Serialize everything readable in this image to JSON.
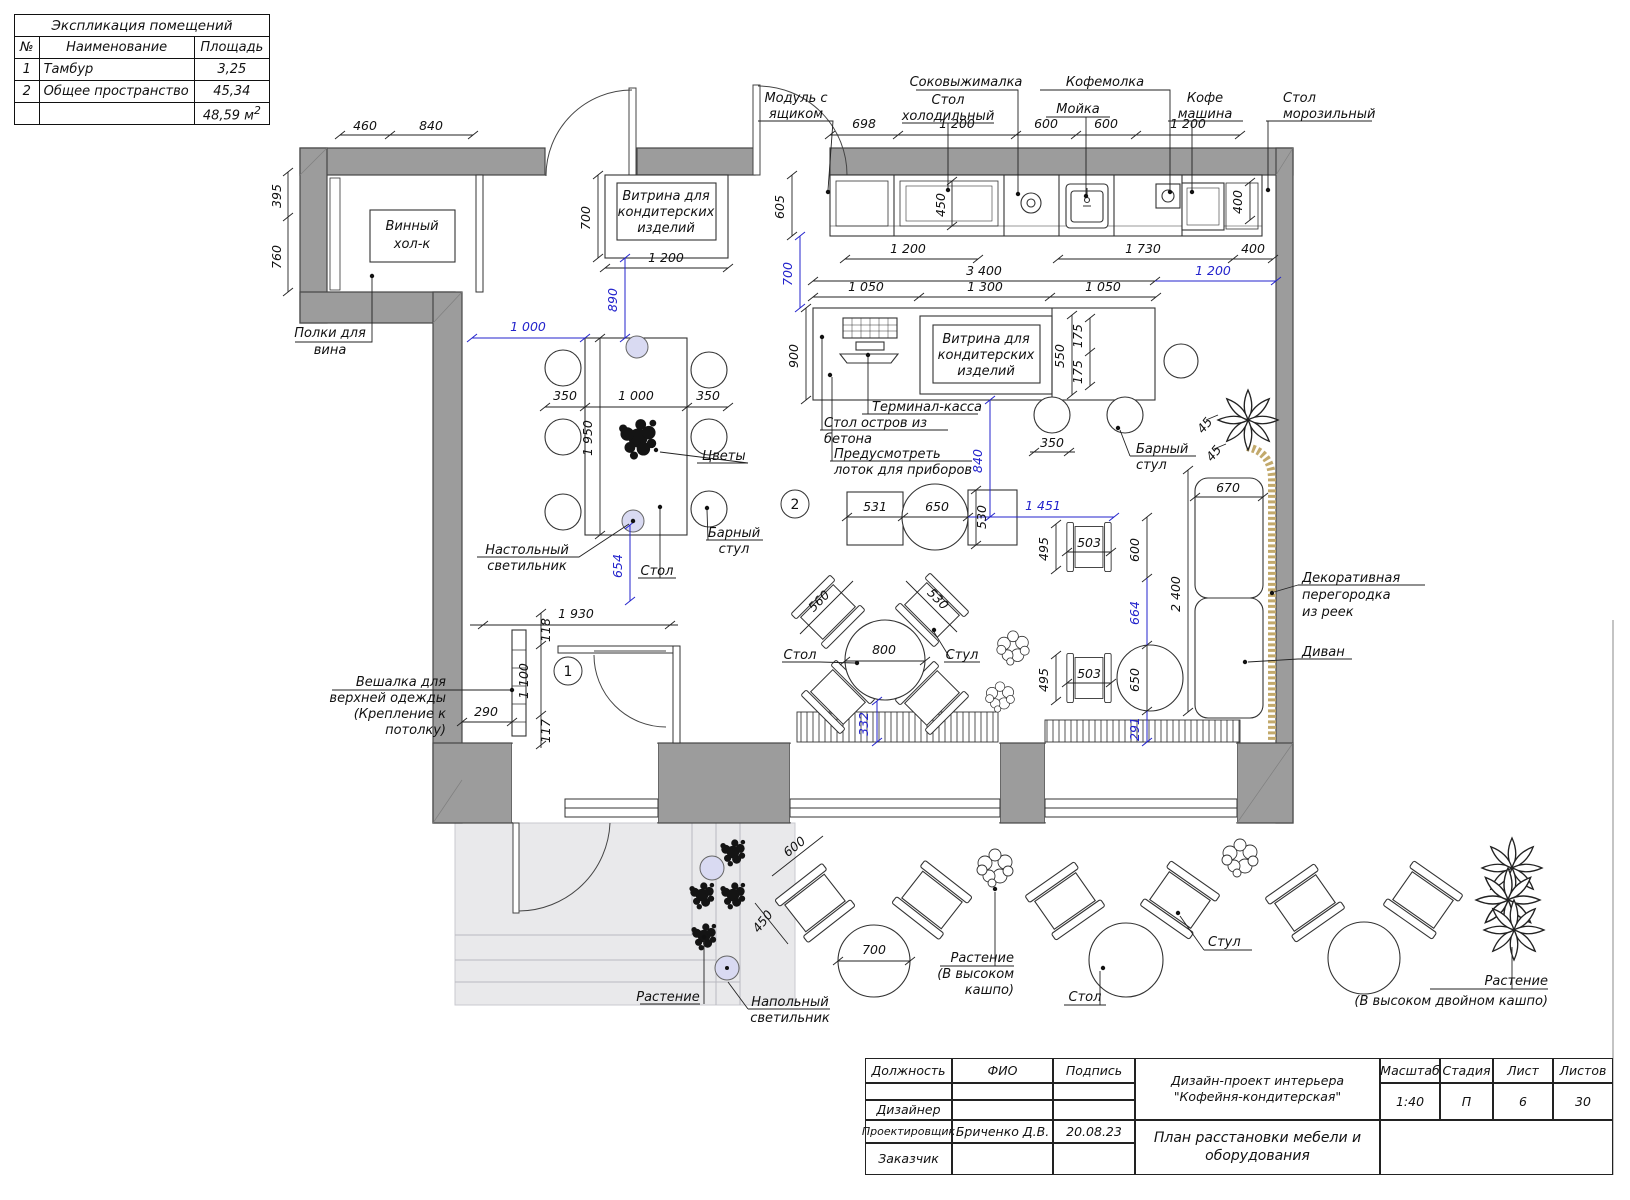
{
  "legend": {
    "title": "Экспликация помещений",
    "columns": {
      "num": "№",
      "name": "Наименование",
      "area": "Площадь"
    },
    "rows": [
      {
        "num": "1",
        "name": "Тамбур",
        "area": "3,25"
      },
      {
        "num": "2",
        "name": "Общее пространство",
        "area": "45,34"
      }
    ],
    "total": "48,59 м",
    "total_sup": "2"
  },
  "plan": {
    "rooms": {
      "r1": "1",
      "r2": "2"
    },
    "d": {
      "d460": "460",
      "d840": "840",
      "d395": "395",
      "d760": "760",
      "d700v": "700",
      "d1200v": "1 200",
      "d698": "698",
      "d1200f": "1 200",
      "d600j": "600",
      "d600m": "600",
      "d1200c": "1 200",
      "d605": "605",
      "d450": "450",
      "d400r": "400",
      "d1200b": "1 200",
      "d1730": "1 730",
      "d400h": "400",
      "d3400": "3 400",
      "d1050a": "1 050",
      "d1300": "1 300",
      "d1050b": "1 050",
      "d900": "900",
      "d550": "550",
      "d175a": "175",
      "d175b": "175",
      "d350s": "350",
      "d45a": "45",
      "d45b": "45",
      "d670": "670",
      "d2400": "2 400",
      "d350l": "350",
      "d1000t": "1 000",
      "d350r": "350",
      "d1950": "1 950",
      "d1930": "1 930",
      "d118": "118",
      "d1100": "1 100",
      "d117": "117",
      "d290": "290",
      "d531": "531",
      "d650c": "650",
      "d530v": "530",
      "d495a": "495",
      "d503a": "503",
      "d600r": "600",
      "d495b": "495",
      "d503b": "503",
      "d650r": "650",
      "d560": "560",
      "d530ch": "530",
      "d800": "800",
      "d600o": "600",
      "d450o": "450",
      "d700o": "700"
    },
    "b": {
      "b1000": "1 000",
      "b890": "890",
      "b700": "700",
      "b1200": "1 200",
      "b654": "654",
      "b840": "840",
      "b1451": "1 451",
      "b664": "664",
      "b332": "332",
      "b291": "291"
    },
    "lb": {
      "polki": {
        "l1": "Полки для",
        "l2": "вина"
      },
      "vinhol": {
        "l1": "Винный",
        "l2": "хол-к"
      },
      "vitrina1": {
        "l1": "Витрина для",
        "l2": "кондитерских",
        "l3": "изделий"
      },
      "modul": {
        "l1": "Модуль с",
        "l2": "ящиком"
      },
      "sokovyzh": "Соковыжималка",
      "stolhol": {
        "l1": "Стол",
        "l2": "холодильный"
      },
      "kofemolka": "Кофемолка",
      "moyka": "Мойка",
      "kofemash": {
        "l1": "Кофе",
        "l2": "машина"
      },
      "stolmoroz": {
        "l1": "Стол",
        "l2": "морозильный"
      },
      "vitrina2": {
        "l1": "Витрина для",
        "l2": "кондитерских",
        "l3": "изделий"
      },
      "terminal": "Терминал-касса",
      "stolostrov": {
        "l1": "Стол остров из",
        "l2": "бетона"
      },
      "predusm": {
        "l1": "Предусмотреть",
        "l2": "лоток для приборов"
      },
      "barstul1": {
        "l1": "Барный",
        "l2": "стул"
      },
      "cvety": "Цветы",
      "nastolsvet": {
        "l1": "Настольный",
        "l2": "светильник"
      },
      "stol1": "Стол",
      "barstul2": {
        "l1": "Барный",
        "l2": "стул"
      },
      "veshalka": {
        "l1": "Вешалка для",
        "l2": "верхней одежды",
        "l3": "(Крепление к",
        "l4": "потолку)"
      },
      "stol2": "Стол",
      "stul2": "Стул",
      "dekor": {
        "l1": "Декоративная",
        "l2": "перегородка",
        "l3": "из реек"
      },
      "divan": "Диван",
      "rast1": "Растение",
      "napolsvet": {
        "l1": "Напольный",
        "l2": "светильник"
      },
      "rast2": {
        "l1": "Растение",
        "l2": "(В высоком",
        "l3": "кашпо)"
      },
      "stul3": "Стул",
      "stol3": "Стол",
      "rast3": {
        "l1": "Растение",
        "l2": "(В высоком двойном кашпо)"
      }
    }
  },
  "titleblock": {
    "cols": {
      "dolzhnost": "Должность",
      "fio": "ФИО",
      "podpis": "Подпись"
    },
    "rows": {
      "dizajner": "Дизайнер",
      "proekt": "Проектировщик",
      "zakaz": "Заказчик"
    },
    "fio_value": "Бриченко Д.В.",
    "date_value": "20.08.23",
    "project_l1": "Дизайн-проект интерьера",
    "project_l2": "\"Кофейня-кондитерская\"",
    "sheet_l1": "План расстановки мебели и",
    "sheet_l2": "оборудования",
    "masshtab_label": "Масштаб",
    "masshtab_value": "1:40",
    "stadiya_label": "Стадия",
    "stadiya_value": "П",
    "list_label": "Лист",
    "list_value": "6",
    "listov_label": "Листов",
    "listov_value": "30"
  },
  "colors": {
    "wall": "#9c9c9c",
    "blue": "#2323cc",
    "lamp": "#d9daf2",
    "partition": "#c2a96b",
    "platform": "#e9e9eb"
  }
}
